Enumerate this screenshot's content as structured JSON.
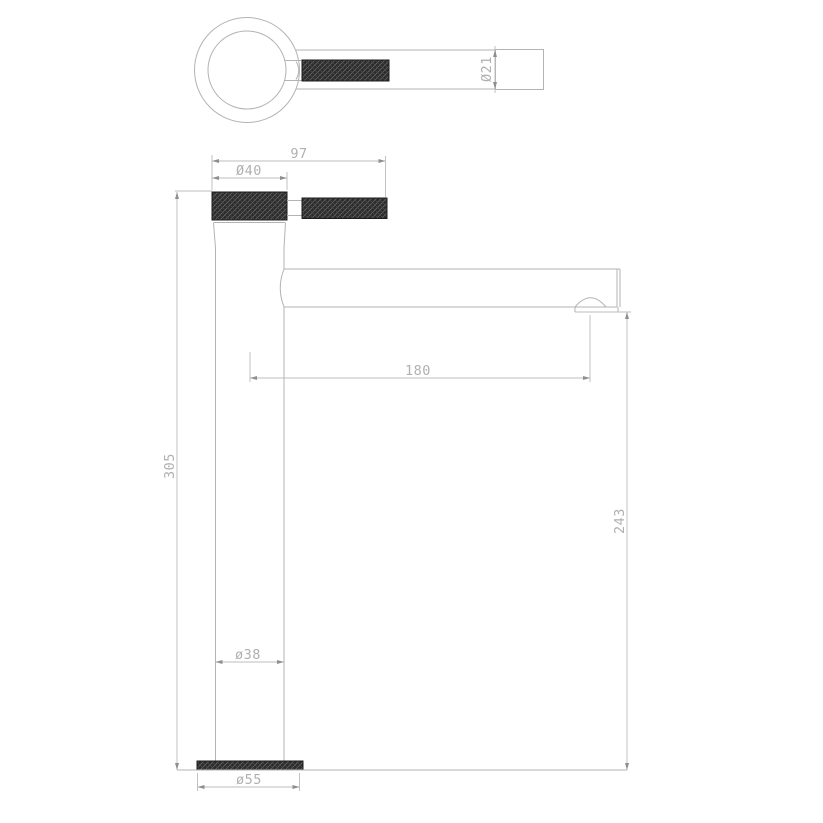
{
  "drawing": {
    "dimensions": {
      "handle_end_diameter": "Ø21",
      "handle_length": "97",
      "cap_diameter": "Ø40",
      "spout_reach": "180",
      "total_height": "305",
      "spout_height": "243",
      "body_diameter": "ø38",
      "base_diameter": "ø55"
    },
    "colors": {
      "line": "#b3b3b3",
      "text": "#b0b0b0",
      "knurl_fill": "#2b2b2b",
      "knurl_hatch": "#6f6f6f",
      "background": "#ffffff"
    }
  }
}
